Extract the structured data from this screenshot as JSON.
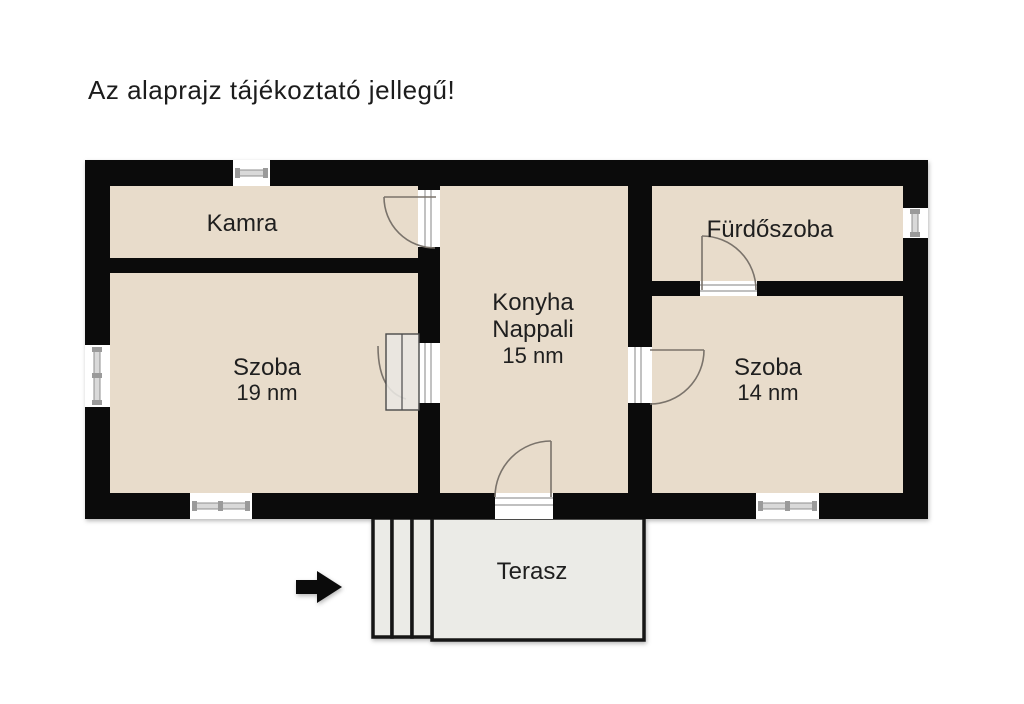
{
  "page": {
    "title": "Az alaprajz tájékoztató jellegű!"
  },
  "rooms": {
    "kamra": {
      "label": "Kamra"
    },
    "szoba_left": {
      "label": "Szoba",
      "area": "19 nm"
    },
    "konyha": {
      "label_line1": "Konyha",
      "label_line2": "Nappali",
      "area": "15 nm"
    },
    "furdoszoba": {
      "label": "Fürdőszoba"
    },
    "szoba_right": {
      "label": "Szoba",
      "area": "14 nm"
    },
    "terasz": {
      "label": "Terasz"
    }
  },
  "icons": {
    "entrance_arrow": "arrow-right"
  },
  "colors": {
    "background": "#ffffff",
    "wall": "#0b0b0b",
    "floor": "#e8dccb",
    "terrace": "#ebebe7",
    "window_bar": "#d9d9d9",
    "door_arc": "#7a736b",
    "text": "#1c1c1c"
  }
}
